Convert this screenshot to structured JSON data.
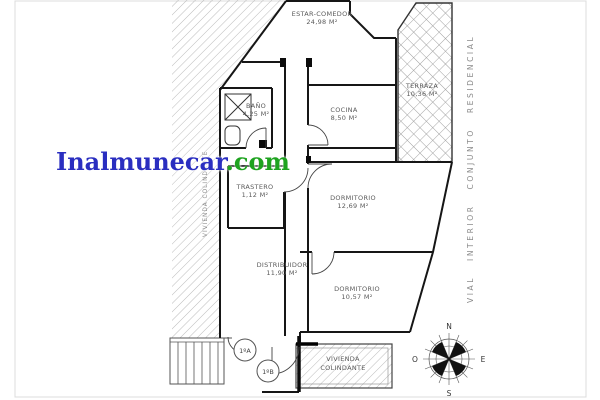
{
  "watermark": {
    "brand": "Inalmunecar",
    "tld": ".com",
    "brand_color": "#2a2ec0",
    "tld_color": "#1fa320"
  },
  "labels": {
    "street_vertical": "VIAL INTERIOR CONJUNTO RESIDENCIAL",
    "neighbor_vertical": "VIVIENDA COLINDANTE",
    "neighbor_box_line1": "VIVIENDA",
    "neighbor_box_line2": "COLINDANTE"
  },
  "rooms": {
    "living": {
      "name": "ESTAR-COMEDOR",
      "area": "24,98 M²"
    },
    "terrace": {
      "name": "TERRAZA",
      "area": "10,36 M²"
    },
    "kitchen": {
      "name": "COCINA",
      "area": "8,50 M²"
    },
    "bath": {
      "name": "BAÑO",
      "area": "4,25 M²"
    },
    "storage": {
      "name": "TRASTERO",
      "area": "1,12 M²"
    },
    "bedroom1": {
      "name": "DORMITORIO",
      "area": "12,69 M²"
    },
    "hall": {
      "name": "DISTRIBUIDOR",
      "area": "11,90 M²"
    },
    "bedroom2": {
      "name": "DORMITORIO",
      "area": "10,57 M²"
    }
  },
  "units": {
    "a": "1ºA",
    "b": "1ºB"
  },
  "compass": {
    "north": "N",
    "south": "S",
    "east": "E",
    "west": "O"
  }
}
